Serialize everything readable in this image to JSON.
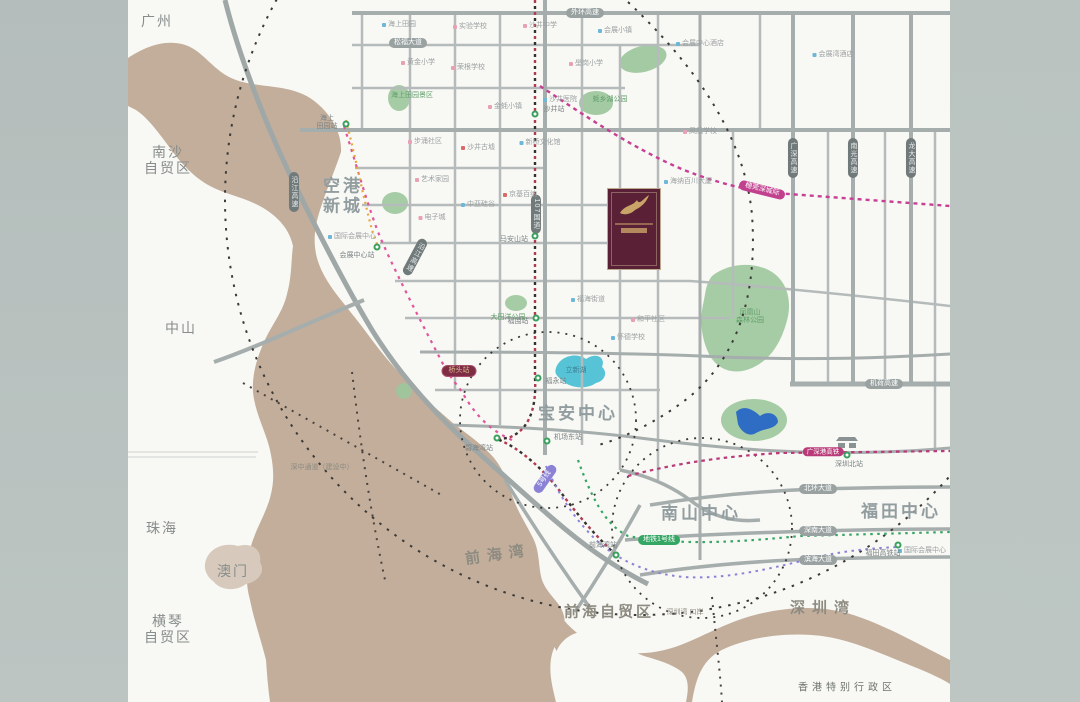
{
  "map": {
    "colors": {
      "sea": "#c2ae9b",
      "land": "#f8f8f4",
      "side_bands": "#b8c1be",
      "road": "#a9b0b0",
      "park": "#9cc69c",
      "lake_teal": "#56c3d6",
      "lake_blue": "#2f6cc4",
      "metro_red": "#b23b50",
      "metro_pink": "#e0559b",
      "metro_orange": "#e5a83e",
      "metro_green": "#35a663",
      "metro_purple": "#8b82d6",
      "intercity_magenta": "#c2418f",
      "project_maroon": "#5a2036",
      "project_gold": "#c9a468",
      "ring_dash": "#3c3a36",
      "poi_dots": {
        "blue": "#6db7d8",
        "pink": "#e8a0b4",
        "red": "#d86a6a",
        "green": "#7bbf8e"
      }
    },
    "labels": [
      {
        "cls": "region",
        "text": "广州",
        "x": 157,
        "y": 21,
        "name": "label-guangzhou"
      },
      {
        "cls": "region",
        "text": "南沙\n自贸区",
        "x": 168,
        "y": 160,
        "name": "label-nansha-ftz"
      },
      {
        "cls": "region",
        "text": "中山",
        "x": 181,
        "y": 328,
        "name": "label-zhongshan"
      },
      {
        "cls": "region",
        "text": "珠海",
        "x": 162,
        "y": 528,
        "name": "label-zhuhai"
      },
      {
        "cls": "region",
        "text": "澳门",
        "x": 233,
        "y": 571,
        "name": "label-macau"
      },
      {
        "cls": "region",
        "text": "横琴\n自贸区",
        "x": 168,
        "y": 629,
        "name": "label-hengqin-ftz"
      },
      {
        "cls": "region-sm",
        "text": "香港特别行政区",
        "x": 847,
        "y": 688,
        "name": "label-hongkong-sar"
      },
      {
        "cls": "sea",
        "text": "前海湾",
        "x": 498,
        "y": 555,
        "rot": -8,
        "name": "label-qianhai-bay"
      },
      {
        "cls": "sea",
        "text": "深圳湾",
        "x": 823,
        "y": 608,
        "name": "label-shenzhen-bay"
      },
      {
        "cls": "sea2",
        "text": "前海自贸区",
        "x": 609,
        "y": 612,
        "name": "label-qianhai-ftz"
      },
      {
        "cls": "district",
        "text": "空港\n新城",
        "x": 343,
        "y": 196,
        "name": "label-airport-new-town"
      },
      {
        "cls": "district",
        "text": "宝安中心",
        "x": 578,
        "y": 414,
        "name": "label-baoan-center"
      },
      {
        "cls": "district",
        "text": "南山中心",
        "x": 701,
        "y": 514,
        "name": "label-nanshan-center"
      },
      {
        "cls": "district",
        "text": "福田中心",
        "x": 901,
        "y": 512,
        "name": "label-futian-center"
      },
      {
        "cls": "capgray",
        "text": "外环高速",
        "x": 585,
        "y": 13,
        "name": "road-label-waihuan"
      },
      {
        "cls": "capgray",
        "text": "松福大道",
        "x": 408,
        "y": 43,
        "name": "road-label-songfu"
      },
      {
        "cls": "capdark",
        "text": "沿江高速",
        "x": 294,
        "y": 192,
        "name": "road-label-yanjiang-1"
      },
      {
        "cls": "capdark",
        "text": "沿江高速",
        "x": 415,
        "y": 257,
        "rot": 28,
        "name": "road-label-yanjiang-2"
      },
      {
        "cls": "capdark",
        "text": "107国道",
        "x": 536,
        "y": 214,
        "name": "road-label-g107"
      },
      {
        "cls": "capdark",
        "text": "广深高速",
        "x": 793,
        "y": 158,
        "name": "road-label-guangshen"
      },
      {
        "cls": "capdark",
        "text": "南光高速",
        "x": 853,
        "y": 158,
        "name": "road-label-nanguang"
      },
      {
        "cls": "capdark",
        "text": "龙大高速",
        "x": 911,
        "y": 158,
        "name": "road-label-longda"
      },
      {
        "cls": "capgray",
        "text": "机荷高速",
        "x": 884,
        "y": 384,
        "name": "road-label-jihe"
      },
      {
        "cls": "capgray",
        "text": "北环大道",
        "x": 818,
        "y": 489,
        "name": "road-label-beihuan"
      },
      {
        "cls": "capgray",
        "text": "深南大道",
        "x": 818,
        "y": 531,
        "name": "road-label-shennan"
      },
      {
        "cls": "capgray",
        "text": "滨海大道",
        "x": 818,
        "y": 560,
        "name": "road-label-binhai"
      },
      {
        "cls": "capmag",
        "text": "穗莞深城际",
        "x": 762,
        "y": 190,
        "rot": 14,
        "name": "line-label-suiguanshen"
      },
      {
        "cls": "caphsr",
        "text": "广深港高铁",
        "x": 823,
        "y": 452,
        "name": "line-label-hsr"
      },
      {
        "cls": "capmaroon",
        "text": "桥头站",
        "x": 459,
        "y": 371,
        "name": "station-label-qiaotou-highlight"
      },
      {
        "cls": "cappurple",
        "text": "5号线",
        "x": 545,
        "y": 479,
        "rot": -55,
        "name": "line-label-metro5"
      },
      {
        "cls": "capgreen",
        "text": "地铁1号线",
        "x": 659,
        "y": 540,
        "name": "line-label-metro1"
      },
      {
        "cls": "poi",
        "dot": "blue",
        "text": "海上田园",
        "x": 399,
        "y": 25
      },
      {
        "cls": "poi",
        "dot": "pink",
        "text": "实验学校",
        "x": 470,
        "y": 27
      },
      {
        "cls": "poi",
        "dot": "pink",
        "text": "沙井中学",
        "x": 540,
        "y": 26
      },
      {
        "cls": "poi",
        "dot": "blue",
        "text": "会展小镇",
        "x": 615,
        "y": 31
      },
      {
        "cls": "poi",
        "dot": "blue",
        "text": "会展中心酒店",
        "x": 700,
        "y": 44
      },
      {
        "cls": "poi",
        "dot": "blue",
        "text": "会展湾酒店",
        "x": 833,
        "y": 55
      },
      {
        "cls": "poi",
        "dot": "pink",
        "text": "黄金小学",
        "x": 418,
        "y": 63
      },
      {
        "cls": "poi",
        "dot": "pink",
        "text": "荣根学校",
        "x": 468,
        "y": 68
      },
      {
        "cls": "poi",
        "dot": "pink",
        "text": "壆岗小学",
        "x": 586,
        "y": 64
      },
      {
        "cls": "park",
        "text": "海上田园景区",
        "x": 412,
        "y": 96
      },
      {
        "cls": "poi",
        "dot": "pink",
        "text": "金蚝小镇",
        "x": 505,
        "y": 107
      },
      {
        "cls": "poi",
        "dot": "blue",
        "text": "沙井医院",
        "x": 560,
        "y": 100
      },
      {
        "cls": "park",
        "text": "蚝乡湖公园",
        "x": 610,
        "y": 100
      },
      {
        "cls": "poi",
        "dot": "pink",
        "text": "步涌社区",
        "x": 425,
        "y": 142
      },
      {
        "cls": "poi",
        "dot": "red",
        "text": "沙井古墟",
        "x": 478,
        "y": 148
      },
      {
        "cls": "poi",
        "dot": "blue",
        "text": "新桥文化馆",
        "x": 540,
        "y": 143
      },
      {
        "cls": "poi",
        "dot": "pink",
        "text": "艺术家园",
        "x": 432,
        "y": 180
      },
      {
        "cls": "poi",
        "dot": "blue",
        "text": "中亚硅谷",
        "x": 478,
        "y": 205
      },
      {
        "cls": "poi",
        "dot": "red",
        "text": "京基百纳",
        "x": 520,
        "y": 195
      },
      {
        "cls": "poi",
        "dot": "pink",
        "text": "电子城",
        "x": 432,
        "y": 218
      },
      {
        "cls": "poi",
        "dot": "blue",
        "text": "国际会展中心",
        "x": 352,
        "y": 237
      },
      {
        "cls": "poi",
        "dot": "blue",
        "text": "海纳百川大厦",
        "x": 688,
        "y": 182
      },
      {
        "cls": "poi",
        "dot": "pink",
        "text": "凤凰学校",
        "x": 700,
        "y": 132
      },
      {
        "cls": "poi",
        "dot": "blue",
        "text": "福海街道",
        "x": 588,
        "y": 300
      },
      {
        "cls": "poi",
        "dot": "pink",
        "text": "和平社区",
        "x": 648,
        "y": 320
      },
      {
        "cls": "poi",
        "dot": "blue",
        "text": "怀德学校",
        "x": 628,
        "y": 338
      },
      {
        "cls": "park",
        "text": "大田洋公园",
        "x": 508,
        "y": 318
      },
      {
        "cls": "park",
        "text": "凤凰山\n森林公园",
        "x": 750,
        "y": 317
      },
      {
        "cls": "water",
        "text": "立新湖",
        "x": 576,
        "y": 371
      },
      {
        "cls": "seasm",
        "text": "深中通道（建设中）",
        "x": 322,
        "y": 468
      },
      {
        "cls": "poi",
        "dot": "blue",
        "text": "国际会展中心",
        "x": 922,
        "y": 551
      },
      {
        "cls": "seasm",
        "text": "深圳湾\n口岸",
        "x": 685,
        "y": 613
      }
    ],
    "stations": [
      {
        "text": "海上\n田园站",
        "cx": 346,
        "cy": 124,
        "lx": 327,
        "ly": 123
      },
      {
        "text": "沙井站",
        "cx": 535,
        "cy": 114,
        "lx": 554,
        "ly": 110
      },
      {
        "text": "马安山站",
        "cx": 535,
        "cy": 236,
        "lx": 514,
        "ly": 240
      },
      {
        "text": "福围站",
        "cx": 536,
        "cy": 318,
        "lx": 518,
        "ly": 322
      },
      {
        "text": "福永站",
        "cx": 538,
        "cy": 378,
        "lx": 556,
        "ly": 382
      },
      {
        "text": "会展中心站",
        "cx": 377,
        "cy": 247,
        "lx": 357,
        "ly": 256
      },
      {
        "text": "碧海湾站",
        "cx": 497,
        "cy": 438,
        "lx": 479,
        "ly": 449
      },
      {
        "text": "机场东站",
        "cx": 547,
        "cy": 441,
        "lx": 568,
        "ly": 438
      },
      {
        "text": "前海湾站",
        "cx": 616,
        "cy": 555,
        "lx": 603,
        "ly": 546
      },
      {
        "text": "深圳北站",
        "cx": 847,
        "cy": 455,
        "lx": 849,
        "ly": 465
      },
      {
        "text": "福田高铁站",
        "cx": 898,
        "cy": 545,
        "lx": 883,
        "ly": 554
      }
    ],
    "project_marker": {
      "logo": "gold-swoosh-emblem"
    }
  }
}
